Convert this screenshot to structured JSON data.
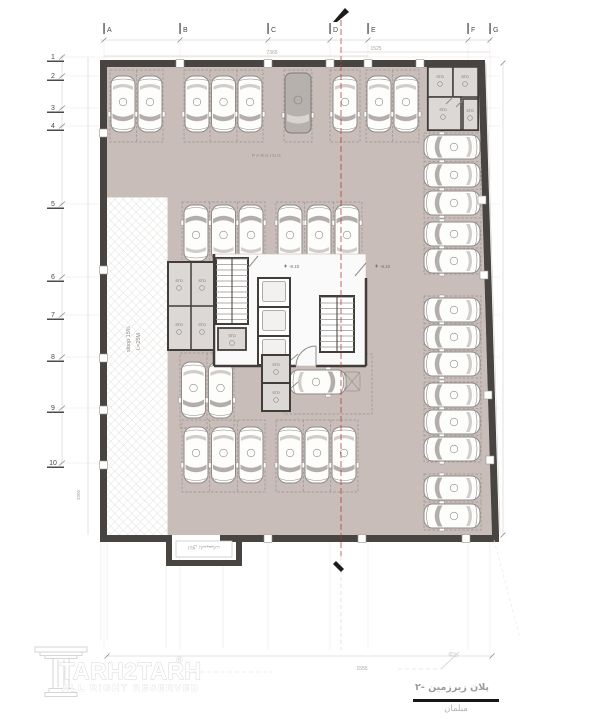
{
  "doc": {
    "grid_columns": [
      "A",
      "B",
      "C",
      "D",
      "E",
      "F",
      "G"
    ],
    "grid_rows": [
      "1",
      "2",
      "3",
      "4",
      "5",
      "6",
      "7",
      "8",
      "9",
      "10"
    ],
    "dims": {
      "top_main": "7365",
      "top_right": "1525",
      "bottom": "1555",
      "left_height": "3300"
    },
    "labels": {
      "parking": "PARKING",
      "sto": "STO",
      "level": "-8.10",
      "slope": "sloop 15%",
      "ramp_len": "L=25M",
      "utility": "اتاق تاسیسات"
    },
    "title_block": {
      "plan_title": "پلان زیرزمین -۲",
      "subtitle": "مبلمان"
    },
    "watermark": {
      "brand": "TARH2TARH",
      "reg": "®",
      "rights": "ALL RIGHT RESERVED"
    },
    "colors": {
      "floor": "#c9bdb9",
      "wall": "#474441",
      "room": "#dbd8d5",
      "centerline": "#b23b35"
    }
  }
}
